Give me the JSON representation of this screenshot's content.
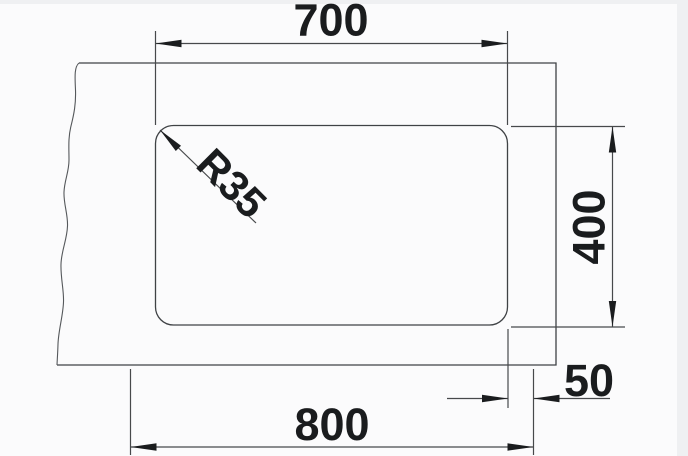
{
  "drawing": {
    "kind": "technical-dimension-drawing",
    "view": "top-view-sink-cutout",
    "units": "mm",
    "labels": {
      "bowl_width_top": "700",
      "bowl_depth_right": "400",
      "edge_offset_right": "50",
      "cabinet_width_bottom": "800",
      "corner_radius": "R35"
    },
    "dimensions": [
      {
        "name": "bowl-width",
        "value": 700,
        "label": "700",
        "orientation": "horizontal",
        "position": "top"
      },
      {
        "name": "bowl-depth",
        "value": 400,
        "label": "400",
        "orientation": "vertical",
        "position": "right"
      },
      {
        "name": "edge-offset",
        "value": 50,
        "label": "50",
        "orientation": "horizontal",
        "position": "bottom-right"
      },
      {
        "name": "cabinet-width",
        "value": 800,
        "label": "800",
        "orientation": "horizontal",
        "position": "bottom"
      },
      {
        "name": "corner-radius",
        "value": 35,
        "label": "R35",
        "orientation": "diagonal-45",
        "position": "bowl-top-left-corner"
      }
    ],
    "colors": {
      "line": "#47494b",
      "ink": "#1a1c1e",
      "canvas": "#fbfbfc",
      "margin": "#eff0f2"
    }
  }
}
